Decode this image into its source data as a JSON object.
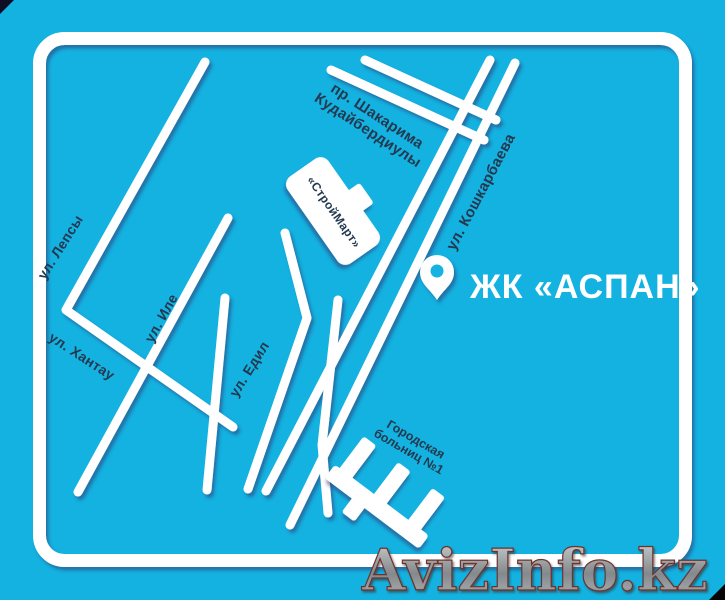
{
  "map": {
    "colors": {
      "background": "#13b2e1",
      "road": "#ffffff",
      "street_label": "#24394f",
      "pin_label": "#ffffff",
      "watermark_fill_top": "#cfd3d4",
      "watermark_fill_bottom": "#6f7578",
      "watermark_outline": "#6e332e"
    },
    "streets": [
      {
        "lines": [
          "ул. Лепсы"
        ]
      },
      {
        "lines": [
          "ул. Иле"
        ]
      },
      {
        "lines": [
          "ул. Хантау"
        ]
      },
      {
        "lines": [
          "ул. Едил"
        ]
      },
      {
        "lines": [
          "пр. Шакарима",
          "Кудайбердиулы"
        ]
      },
      {
        "lines": [
          "ул. Кошкарбаева"
        ]
      }
    ],
    "buildings": {
      "store_label": "«СтройМарт»",
      "hospital_label": [
        "Городская",
        "больниц №1"
      ]
    },
    "poi": {
      "pin_label": "ЖК «АСПАН»"
    },
    "watermark": "AvizInfo.kz"
  }
}
